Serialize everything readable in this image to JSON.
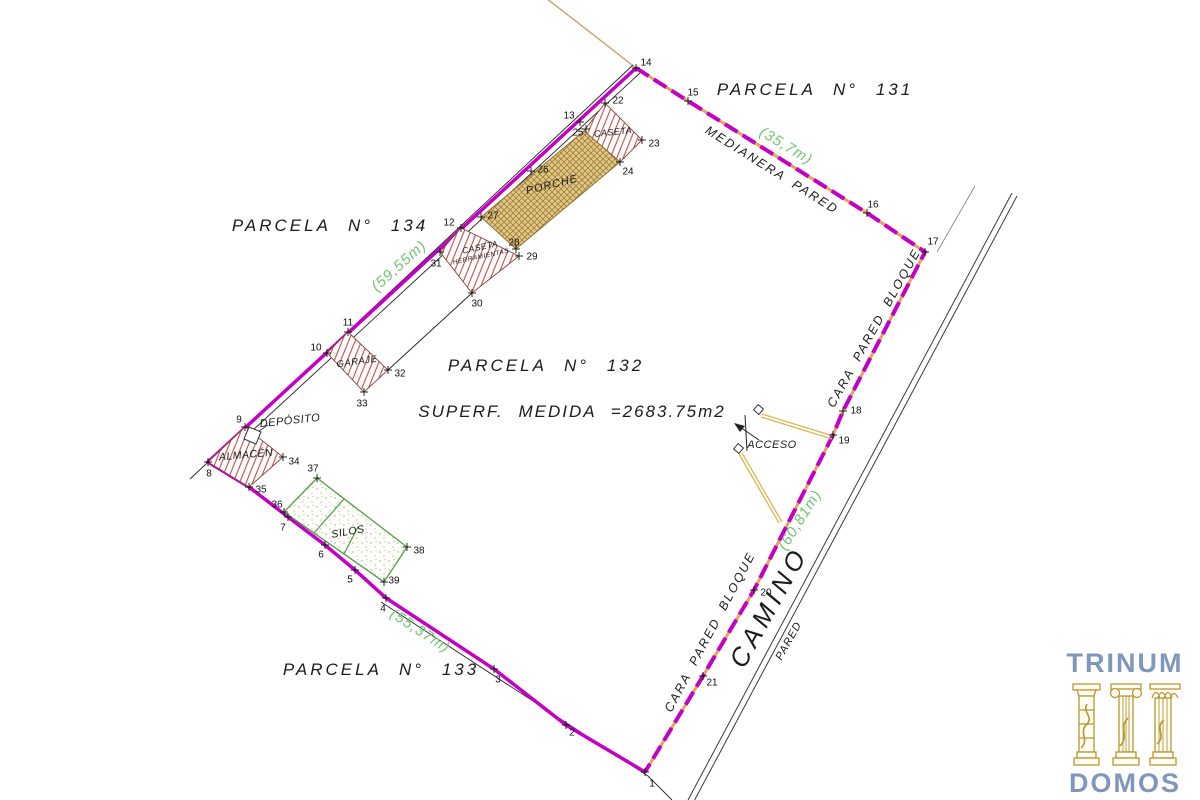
{
  "plan": {
    "parcels": {
      "p131": "PARCELA N° 131",
      "p134": "PARCELA N° 134",
      "p132": "PARCELA N° 132",
      "p133": "PARCELA N° 133"
    },
    "area": "SUPERF. MEDIDA =2683.75m2",
    "walls": {
      "medianera": "MEDIANERA PARED",
      "cara_upper": "CARA PARED BLOQUE",
      "cara_lower": "CARA PARED BLOQUE",
      "camino": "CAMINO",
      "pared": "PARED"
    },
    "measurements": {
      "north": "(35,7m)",
      "west": "(59,55m)",
      "south": "(55,37m)",
      "east": "(60,81m)"
    },
    "structures": {
      "caseta": "CASETA",
      "porche": "PORCHE",
      "caseta_herr_1": "CASETA",
      "caseta_herr_2": "HERRAMIENTAS",
      "garaje": "GARAJE",
      "deposito": "DEPÓSITO",
      "almacen": "ALMACÉN",
      "silos": "SILOS",
      "acceso": "ACCESO"
    },
    "colors": {
      "boundary_magenta": "#c400c4",
      "boundary_gap_tan": "#e2a55a",
      "measurement_green": "#72c472",
      "hatch_red": "#b25454",
      "porche_fill": "#dcca85",
      "silos_green": "#569a4a",
      "logo_blue": "#7e97bb",
      "logo_gold": "#bb962e"
    },
    "points": [
      {
        "n": "1",
        "x": 645,
        "y": 772,
        "cx": 652,
        "cy": 783
      },
      {
        "n": "2",
        "x": 566,
        "y": 725,
        "cx": 572,
        "cy": 732
      },
      {
        "n": "3",
        "x": 494,
        "y": 669,
        "cx": 498,
        "cy": 679
      },
      {
        "n": "4",
        "x": 386,
        "y": 598,
        "cx": 383,
        "cy": 608
      },
      {
        "n": "5",
        "x": 355,
        "y": 570,
        "cx": 350,
        "cy": 579
      },
      {
        "n": "6",
        "x": 325,
        "y": 545,
        "cx": 321,
        "cy": 554
      },
      {
        "n": "7",
        "x": 288,
        "y": 517,
        "cx": 283,
        "cy": 527
      },
      {
        "n": "8",
        "x": 208,
        "y": 462,
        "cx": 209,
        "cy": 473
      },
      {
        "n": "9",
        "x": 245,
        "y": 427,
        "cx": 239,
        "cy": 419
      },
      {
        "n": "10",
        "x": 327,
        "y": 353,
        "cx": 316,
        "cy": 347
      },
      {
        "n": "11",
        "x": 348,
        "y": 332,
        "cx": 348,
        "cy": 322
      },
      {
        "n": "12",
        "x": 461,
        "y": 228,
        "cx": 449,
        "cy": 222
      },
      {
        "n": "13",
        "x": 580,
        "y": 122,
        "cx": 569,
        "cy": 115
      },
      {
        "n": "14",
        "x": 636,
        "y": 68,
        "cx": 646,
        "cy": 62
      },
      {
        "n": "15",
        "x": 688,
        "y": 101,
        "cx": 693,
        "cy": 92
      },
      {
        "n": "16",
        "x": 867,
        "y": 213,
        "cx": 873,
        "cy": 204
      },
      {
        "n": "17",
        "x": 925,
        "y": 252,
        "cx": 933,
        "cy": 241
      },
      {
        "n": "18",
        "x": 843,
        "y": 411,
        "cx": 856,
        "cy": 410
      },
      {
        "n": "19",
        "x": 833,
        "y": 435,
        "cx": 844,
        "cy": 440
      },
      {
        "n": "20",
        "x": 754,
        "y": 590,
        "cx": 766,
        "cy": 592
      },
      {
        "n": "21",
        "x": 703,
        "y": 676,
        "cx": 712,
        "cy": 682
      },
      {
        "n": "22",
        "x": 605,
        "y": 103,
        "cx": 618,
        "cy": 100
      },
      {
        "n": "23",
        "x": 642,
        "y": 140,
        "cx": 654,
        "cy": 143
      },
      {
        "n": "24",
        "x": 620,
        "y": 162,
        "cx": 628,
        "cy": 171
      },
      {
        "n": "25",
        "x": 586,
        "y": 129,
        "cx": 578,
        "cy": 132
      },
      {
        "n": "26",
        "x": 531,
        "y": 171,
        "cx": 543,
        "cy": 169
      },
      {
        "n": "27",
        "x": 481,
        "y": 217,
        "cx": 493,
        "cy": 215
      },
      {
        "n": "28",
        "x": 516,
        "y": 249,
        "cx": 514,
        "cy": 242
      },
      {
        "n": "29",
        "x": 519,
        "y": 256,
        "cx": 532,
        "cy": 256
      },
      {
        "n": "30",
        "x": 472,
        "y": 293,
        "cx": 477,
        "cy": 303
      },
      {
        "n": "31",
        "x": 440,
        "y": 252,
        "cx": 436,
        "cy": 263
      },
      {
        "n": "32",
        "x": 388,
        "y": 370,
        "cx": 400,
        "cy": 373
      },
      {
        "n": "33",
        "x": 364,
        "y": 392,
        "cx": 362,
        "cy": 403
      },
      {
        "n": "34",
        "x": 283,
        "y": 457,
        "cx": 294,
        "cy": 461
      },
      {
        "n": "35",
        "x": 249,
        "y": 487,
        "cx": 261,
        "cy": 489
      },
      {
        "n": "36",
        "x": 284,
        "y": 512,
        "cx": 277,
        "cy": 504
      },
      {
        "n": "37",
        "x": 317,
        "y": 478,
        "cx": 313,
        "cy": 468
      },
      {
        "n": "38",
        "x": 407,
        "y": 547,
        "cx": 419,
        "cy": 550
      },
      {
        "n": "39",
        "x": 384,
        "y": 582,
        "cx": 394,
        "cy": 580
      }
    ]
  },
  "logo": {
    "top": "TRINUM",
    "bottom": "DOMOS"
  }
}
